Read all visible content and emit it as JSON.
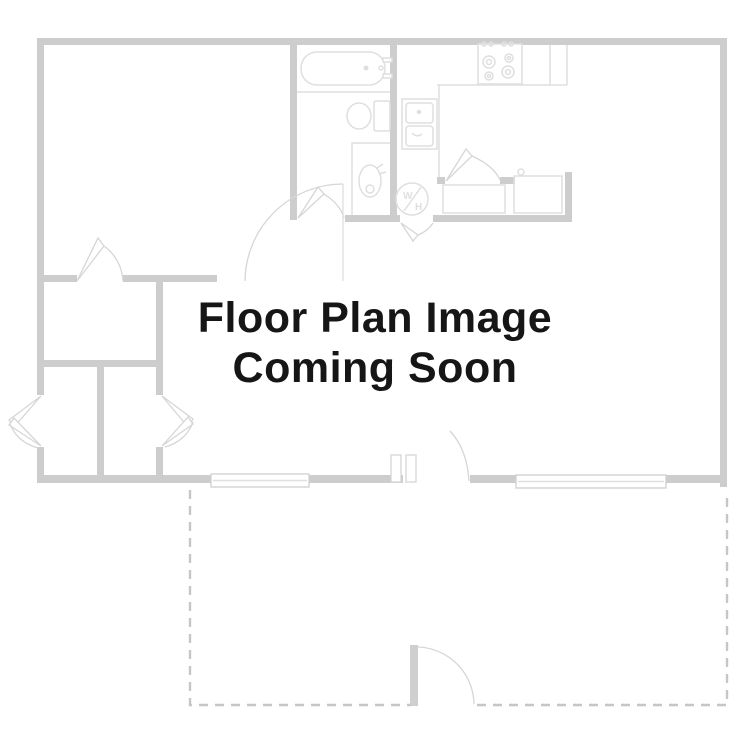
{
  "placeholder": {
    "line1": "Floor Plan Image",
    "line2": "Coming Soon"
  },
  "floor_plan": {
    "water_heater_label": "W/H",
    "water_heater_label_top": "W",
    "water_heater_label_bottom": "H"
  },
  "colors": {
    "wall": "#cdcdcd",
    "fixture_line": "#dfdfdf",
    "door_line": "#d6d6d6",
    "dashed_outline": "#c6c6c6",
    "text": "#161616",
    "background": "#ffffff"
  }
}
